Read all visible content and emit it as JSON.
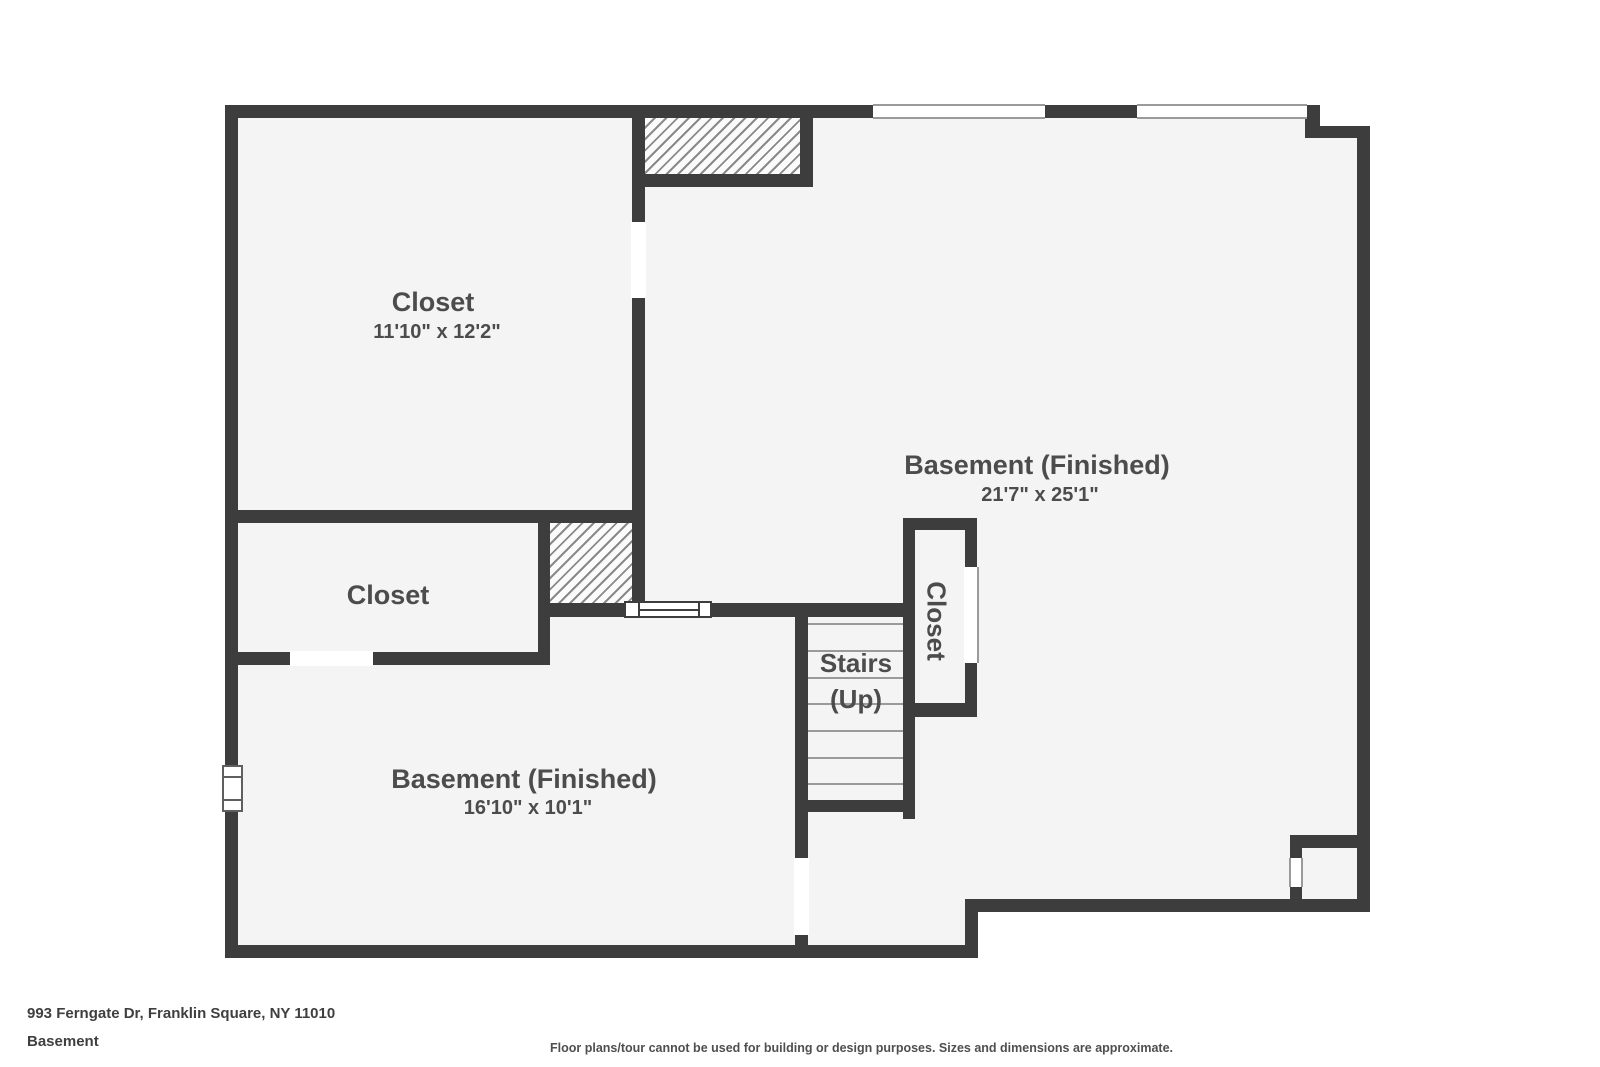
{
  "plan": {
    "colors": {
      "wall": "#3d3d3d",
      "floor": "#f4f4f5",
      "hatch_line": "#8a8a8a",
      "label_text": "#4c4c4c"
    },
    "rooms": {
      "closet_top_left": {
        "label": "Closet",
        "dims": "11'10\" x 12'2\""
      },
      "closet_mid_left": {
        "label": "Closet"
      },
      "closet_stairs": {
        "label": "Closet"
      },
      "stairs": {
        "label_line1": "Stairs",
        "label_line2": "(Up)"
      },
      "basement_main": {
        "label": "Basement (Finished)",
        "dims": "21'7\" x 25'1\""
      },
      "basement_small": {
        "label": "Basement (Finished)",
        "dims": "16'10\" x 10'1\""
      }
    }
  },
  "footer": {
    "address": "993 Ferngate Dr, Franklin Square, NY 11010",
    "level": "Basement",
    "disclaimer": "Floor plans/tour cannot be used for building or design purposes. Sizes and dimensions are approximate."
  }
}
